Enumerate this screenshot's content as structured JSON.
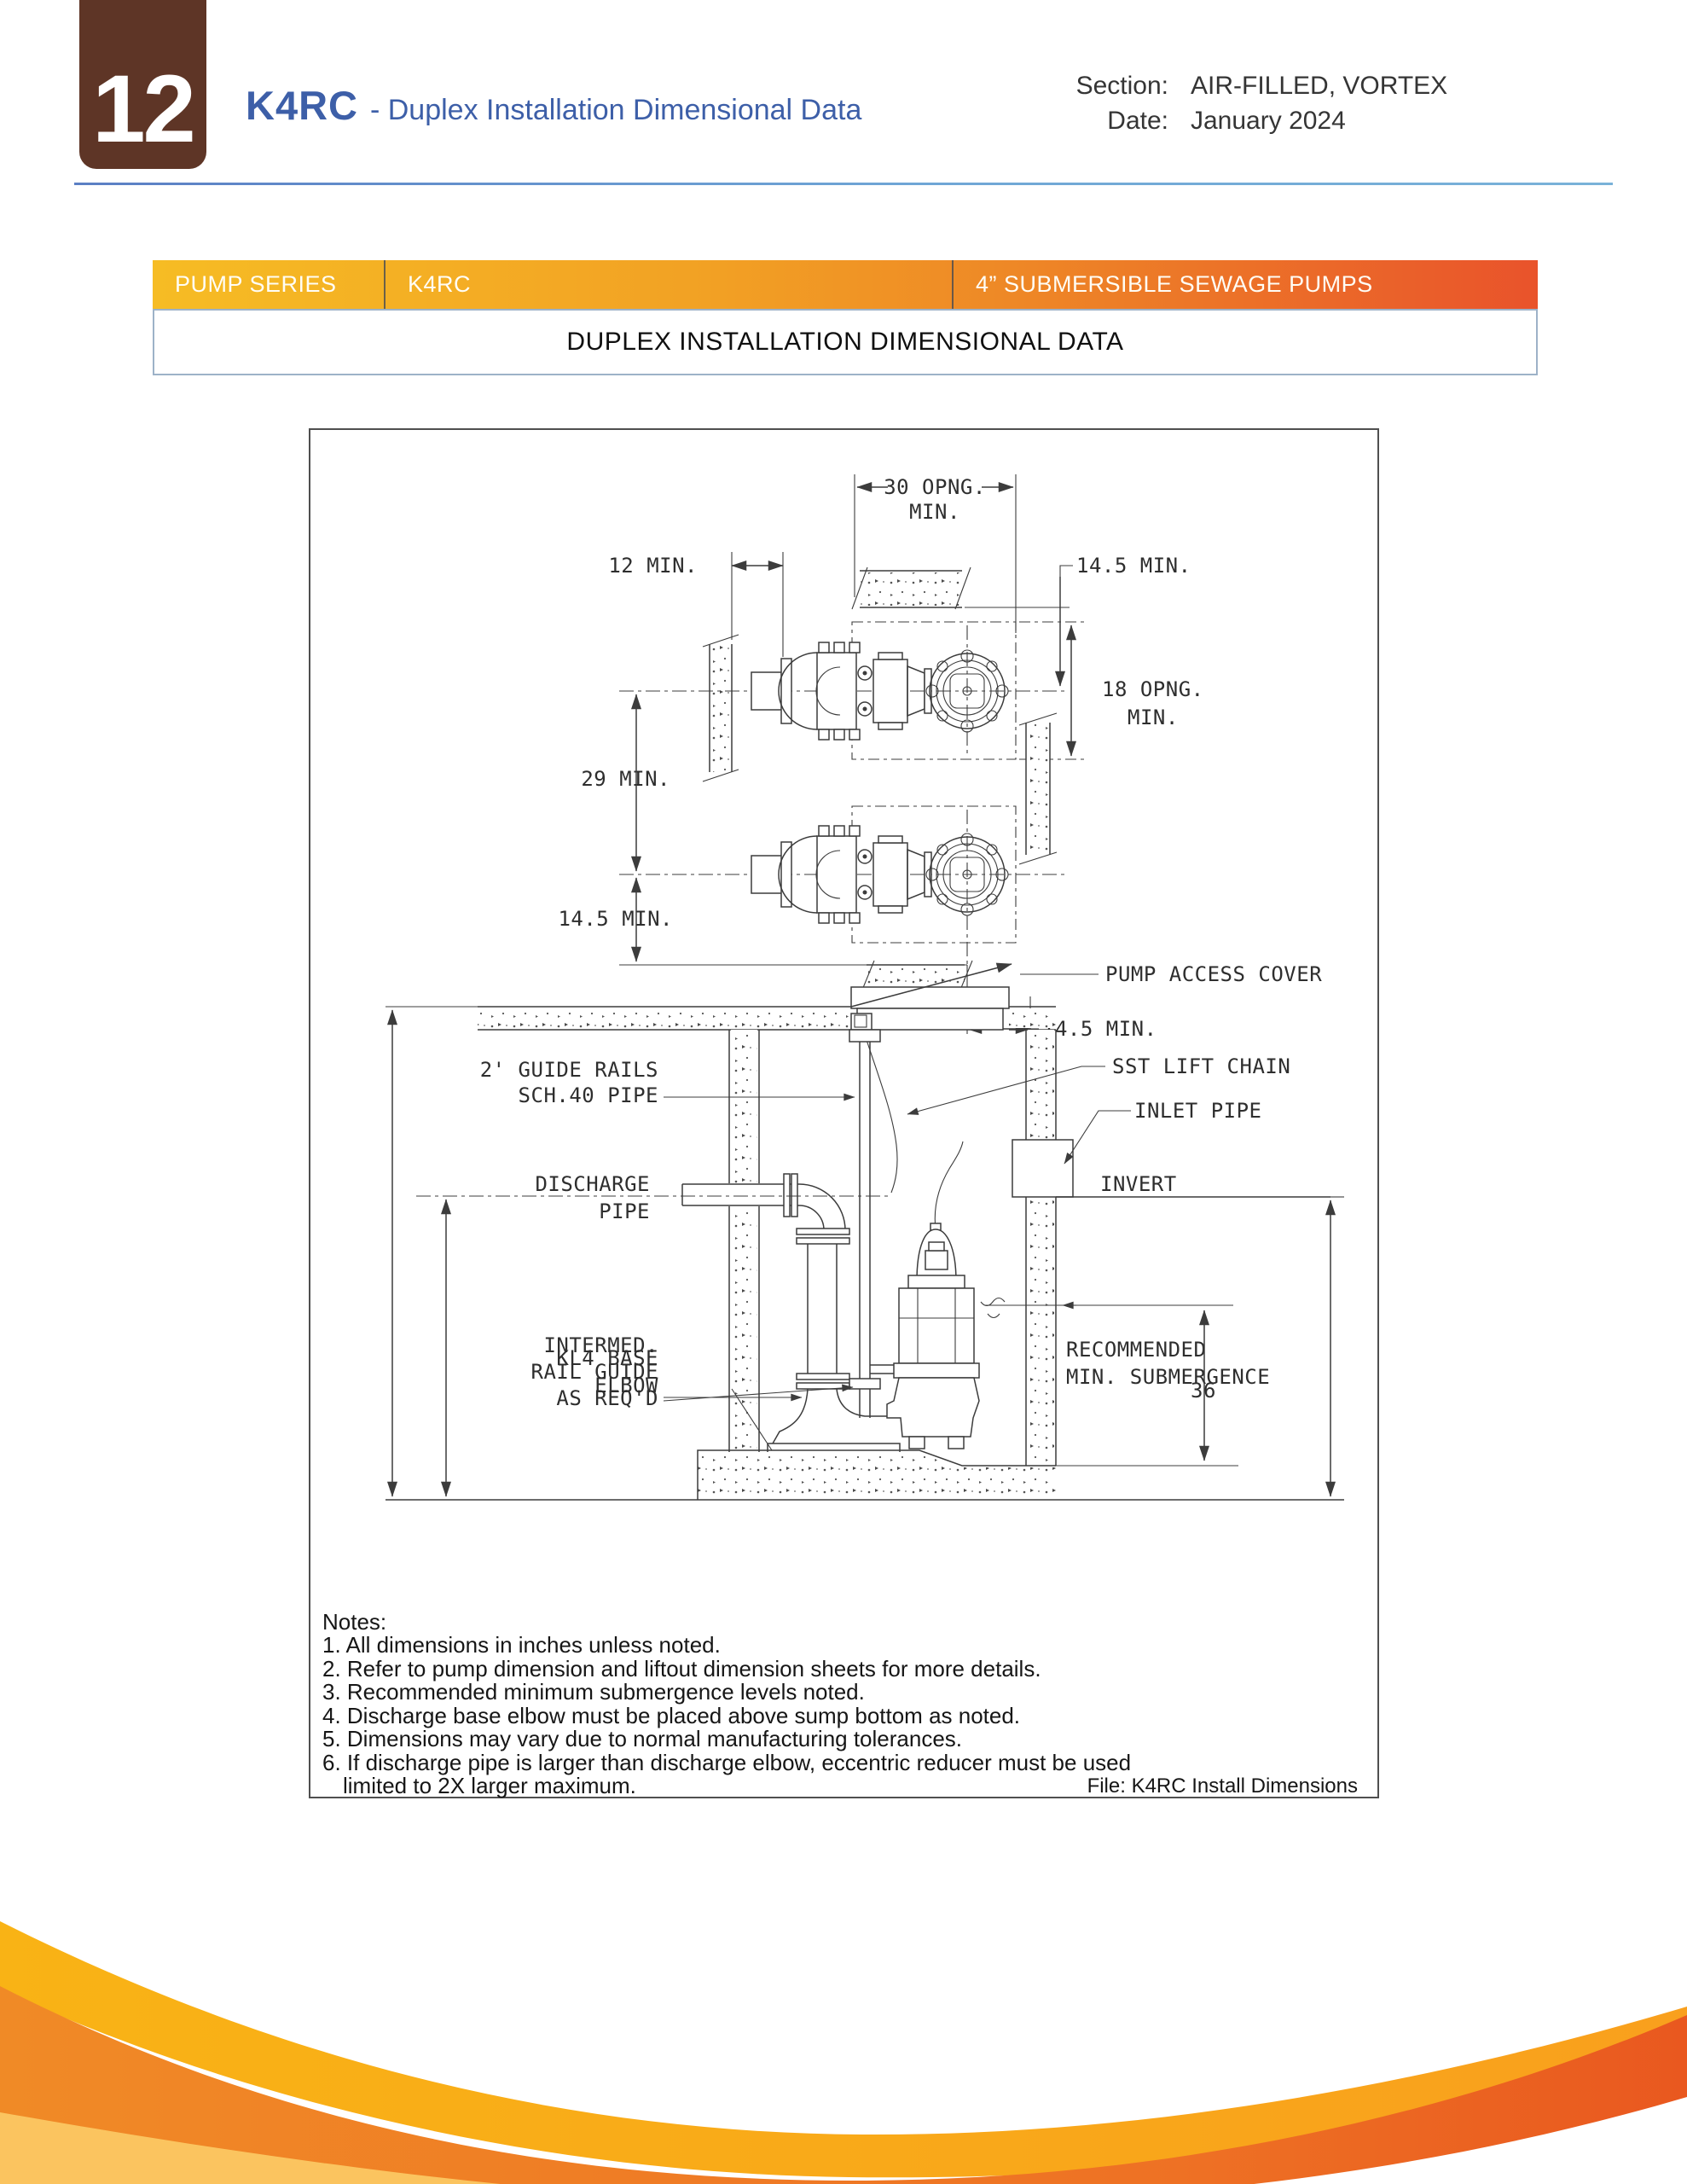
{
  "header": {
    "page_number": "12",
    "title": "K4RC",
    "title_suffix": "- Duplex Installation Dimensional Data",
    "section_label": "Section:",
    "section_value": "AIR-FILLED, VORTEX",
    "date_label": "Date:",
    "date_value": "January 2024"
  },
  "banner": {
    "cell1": "PUMP SERIES",
    "cell2": "K4RC",
    "cell3": "4” SUBMERSIBLE SEWAGE PUMPS",
    "subtitle": "DUPLEX INSTALLATION DIMENSIONAL DATA"
  },
  "drawing": {
    "plan": {
      "opening_width": "30 OPNG.",
      "opening_width_min": "MIN.",
      "left_offset": "12 MIN.",
      "top_offset": "14.5 MIN.",
      "opening_height": "18 OPNG.",
      "opening_height_min": "MIN.",
      "pump_spacing": "29 MIN.",
      "bottom_offset": "14.5 MIN.",
      "right_offset": "14.5 MIN."
    },
    "section": {
      "pump_access_cover": "PUMP ACCESS COVER",
      "guide_rails_line1": "2' GUIDE RAILS",
      "guide_rails_line2": "SCH.40 PIPE",
      "sst_lift_chain": "SST LIFT CHAIN",
      "inlet_pipe": "INLET PIPE",
      "discharge_line1": "DISCHARGE",
      "discharge_line2": "PIPE",
      "invert": "INVERT",
      "intermed_line1": "INTERMED.",
      "intermed_line2": "RAIL GUIDE",
      "intermed_line3": "AS REQ'D",
      "recommended_line1": "RECOMMENDED",
      "recommended_line2": "MIN. SUBMERGENCE",
      "base_elbow_line1": "KL4 BASE",
      "base_elbow_line2": "ELBOW",
      "submergence_value": "36"
    },
    "file_ref": "File: K4RC Install Dimensions"
  },
  "notes": {
    "heading": "Notes:",
    "items": [
      "1. All dimensions in inches unless noted.",
      "2. Refer to pump dimension and liftout dimension sheets for more details.",
      "3. Recommended minimum submergence levels noted.",
      "4. Discharge base elbow must be placed above sump bottom as noted.",
      "5. Dimensions may vary due to normal manufacturing tolerances.",
      "6. If discharge pipe is larger than discharge elbow, eccentric reducer must be used"
    ],
    "continuation": "limited to 2X larger maximum."
  },
  "colors": {
    "brand_brown": "#5E3526",
    "title_blue": "#3D5FA8",
    "rule_blue": "#6FA6D6",
    "banner_gradient_start": "#F6BC24",
    "banner_gradient_mid": "#EE8826",
    "banner_gradient_end": "#E9532B",
    "wave_gold": "#F9A81B",
    "wave_orange": "#EE7124",
    "wave_pale": "#FBC45F"
  }
}
